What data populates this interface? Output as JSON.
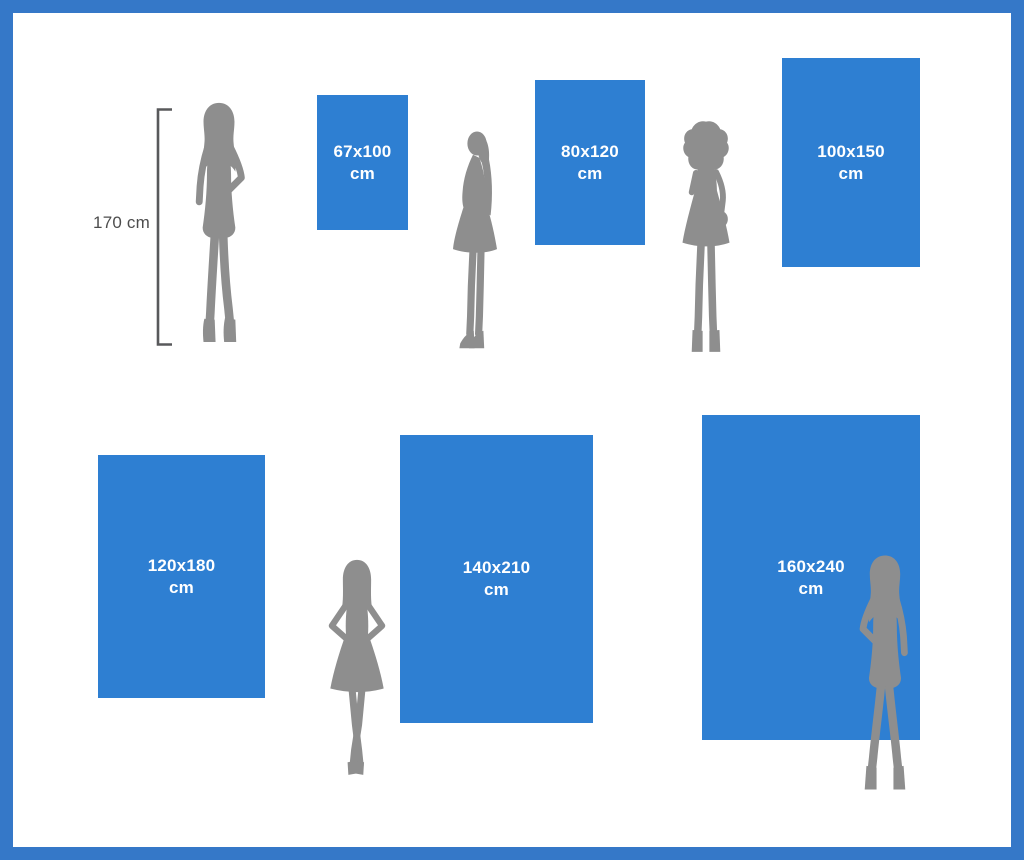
{
  "reference": {
    "height_label": "170 cm"
  },
  "posters": [
    {
      "size": "67x100",
      "unit": "cm"
    },
    {
      "size": "80x120",
      "unit": "cm"
    },
    {
      "size": "100x150",
      "unit": "cm"
    },
    {
      "size": "120x180",
      "unit": "cm"
    },
    {
      "size": "140x210",
      "unit": "cm"
    },
    {
      "size": "160x240",
      "unit": "cm"
    }
  ],
  "icons": {
    "measurement_bracket": "vertical-bracket-with-end-ticks",
    "silhouettes": [
      "woman-standing-hand-on-hip",
      "woman-profile-flared-skirt-heels",
      "woman-curly-hair-hand-to-chin",
      "woman-hands-on-hips-skirt",
      "woman-standing-legs-apart-hand-on-hip"
    ]
  },
  "colors": {
    "frame": "#3578C8",
    "poster_fill": "#2E7FD2",
    "poster_text": "#FFFFFF",
    "silhouette": "#8E8E8E",
    "reference_text": "#4D4D4D",
    "background": "#FFFFFF"
  }
}
